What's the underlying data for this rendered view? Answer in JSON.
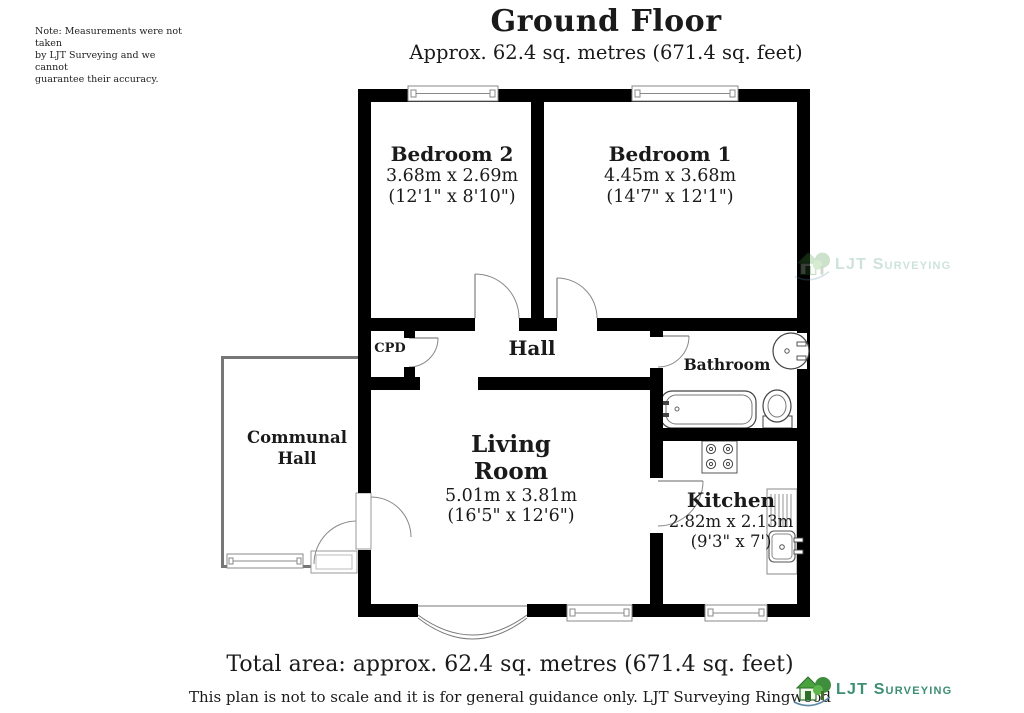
{
  "note": {
    "text": "Note: Measurements were not taken\nby LJT Surveying and we cannot\nguarantee their accuracy."
  },
  "header": {
    "title": "Ground Floor",
    "subtitle": "Approx. 62.4 sq. metres (671.4 sq. feet)"
  },
  "rooms": {
    "bedroom2": {
      "name": "Bedroom 2",
      "metric": "3.68m x 2.69m",
      "imperial": "(12'1\" x 8'10\")"
    },
    "bedroom1": {
      "name": "Bedroom 1",
      "metric": "4.45m x 3.68m",
      "imperial": "(14'7\" x 12'1\")"
    },
    "cpd": {
      "name": "CPD"
    },
    "hall": {
      "name": "Hall"
    },
    "bathroom": {
      "name": "Bathroom"
    },
    "communal_hall": {
      "name": "Communal\nHall"
    },
    "living": {
      "name_line1": "Living",
      "name_line2": "Room",
      "metric": "5.01m x 3.81m",
      "imperial": "(16'5\" x 12'6\")"
    },
    "kitchen": {
      "name": "Kitchen",
      "metric": "2.82m x 2.13m",
      "imperial": "(9'3\" x 7')"
    }
  },
  "footer": {
    "total": "Total area: approx. 62.4 sq. metres (671.4 sq. feet)",
    "disclaimer": "This plan is not to scale and it is for general guidance only. LJT Surveying Ringwood"
  },
  "logo": {
    "text": "LJT Surveying",
    "text_color": "#3c8f72",
    "tree_color": "#3e8e3e",
    "roof_color": "#4aa23c"
  },
  "colors": {
    "wall": "#000000",
    "thin_line": "#888888",
    "text": "#1a1a1a"
  }
}
